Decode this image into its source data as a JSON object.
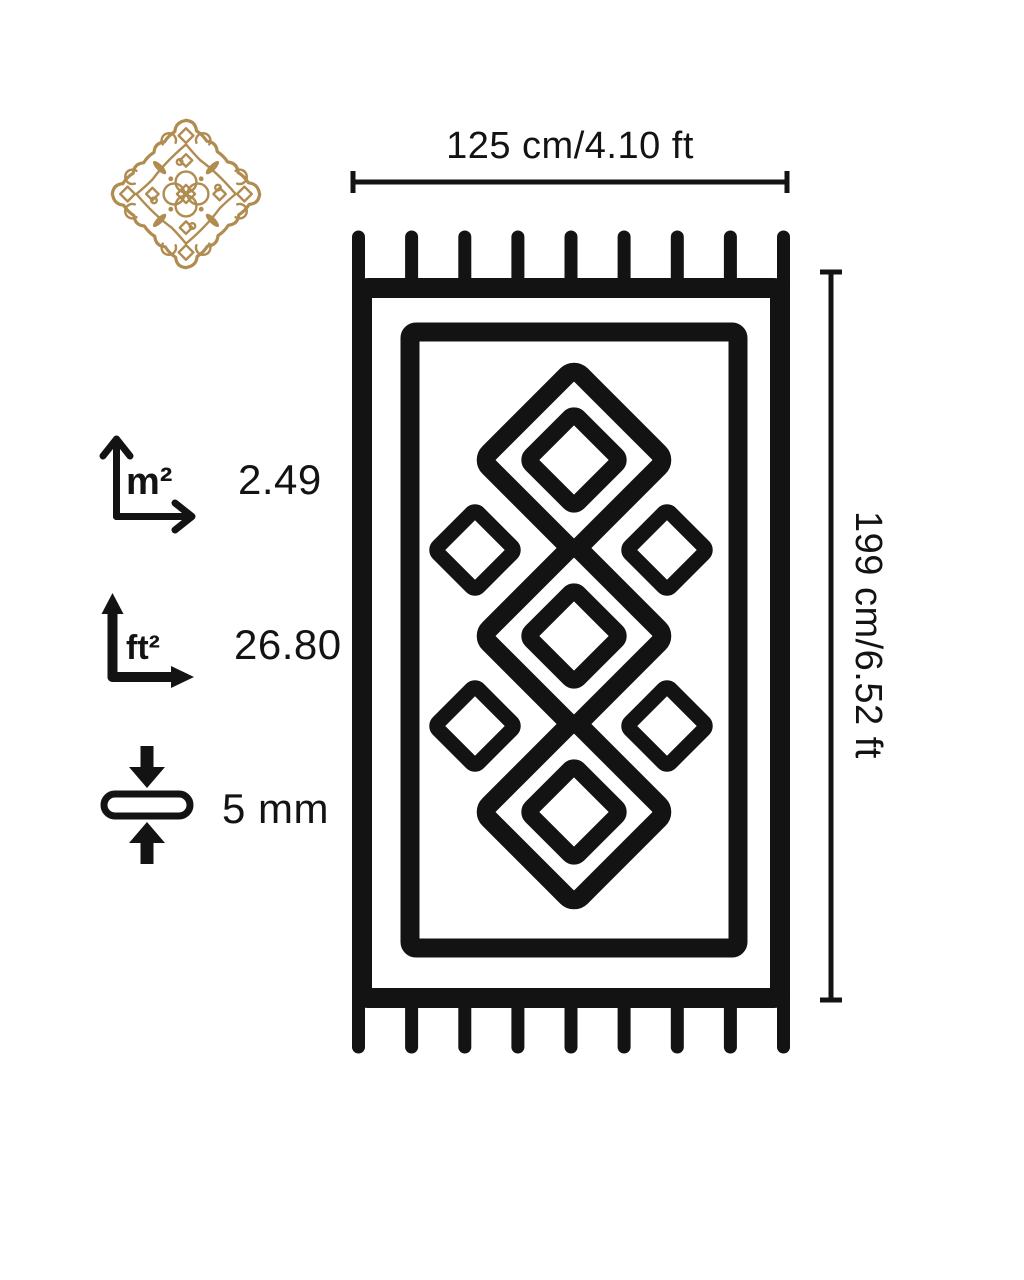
{
  "colors": {
    "ink": "#131313",
    "gold": "#b08c50",
    "background": "#ffffff"
  },
  "dimensions": {
    "width_label": "125 cm/4.10 ft",
    "height_label": "199 cm/6.52 ft"
  },
  "specs": {
    "area_m2": {
      "unit_label": "m²",
      "value": "2.49"
    },
    "area_ft2": {
      "unit_label": "ft²",
      "value": "26.80"
    },
    "thickness": {
      "value": "5 mm"
    }
  },
  "icons": {
    "brand": "ornamental-gold-medallion",
    "area_m2": "axes-arrows-thin-chevron",
    "area_ft2": "axes-arrows-bold-solid",
    "thickness": "pill-compressed-by-arrows",
    "rug": "rug-with-fringe-and-diamond-pattern"
  },
  "rug_pattern": {
    "fringe_tassels_top": 9,
    "fringe_tassels_bottom": 9,
    "large_diamonds": 3,
    "inner_diamonds": 3,
    "side_diamonds": 4
  }
}
